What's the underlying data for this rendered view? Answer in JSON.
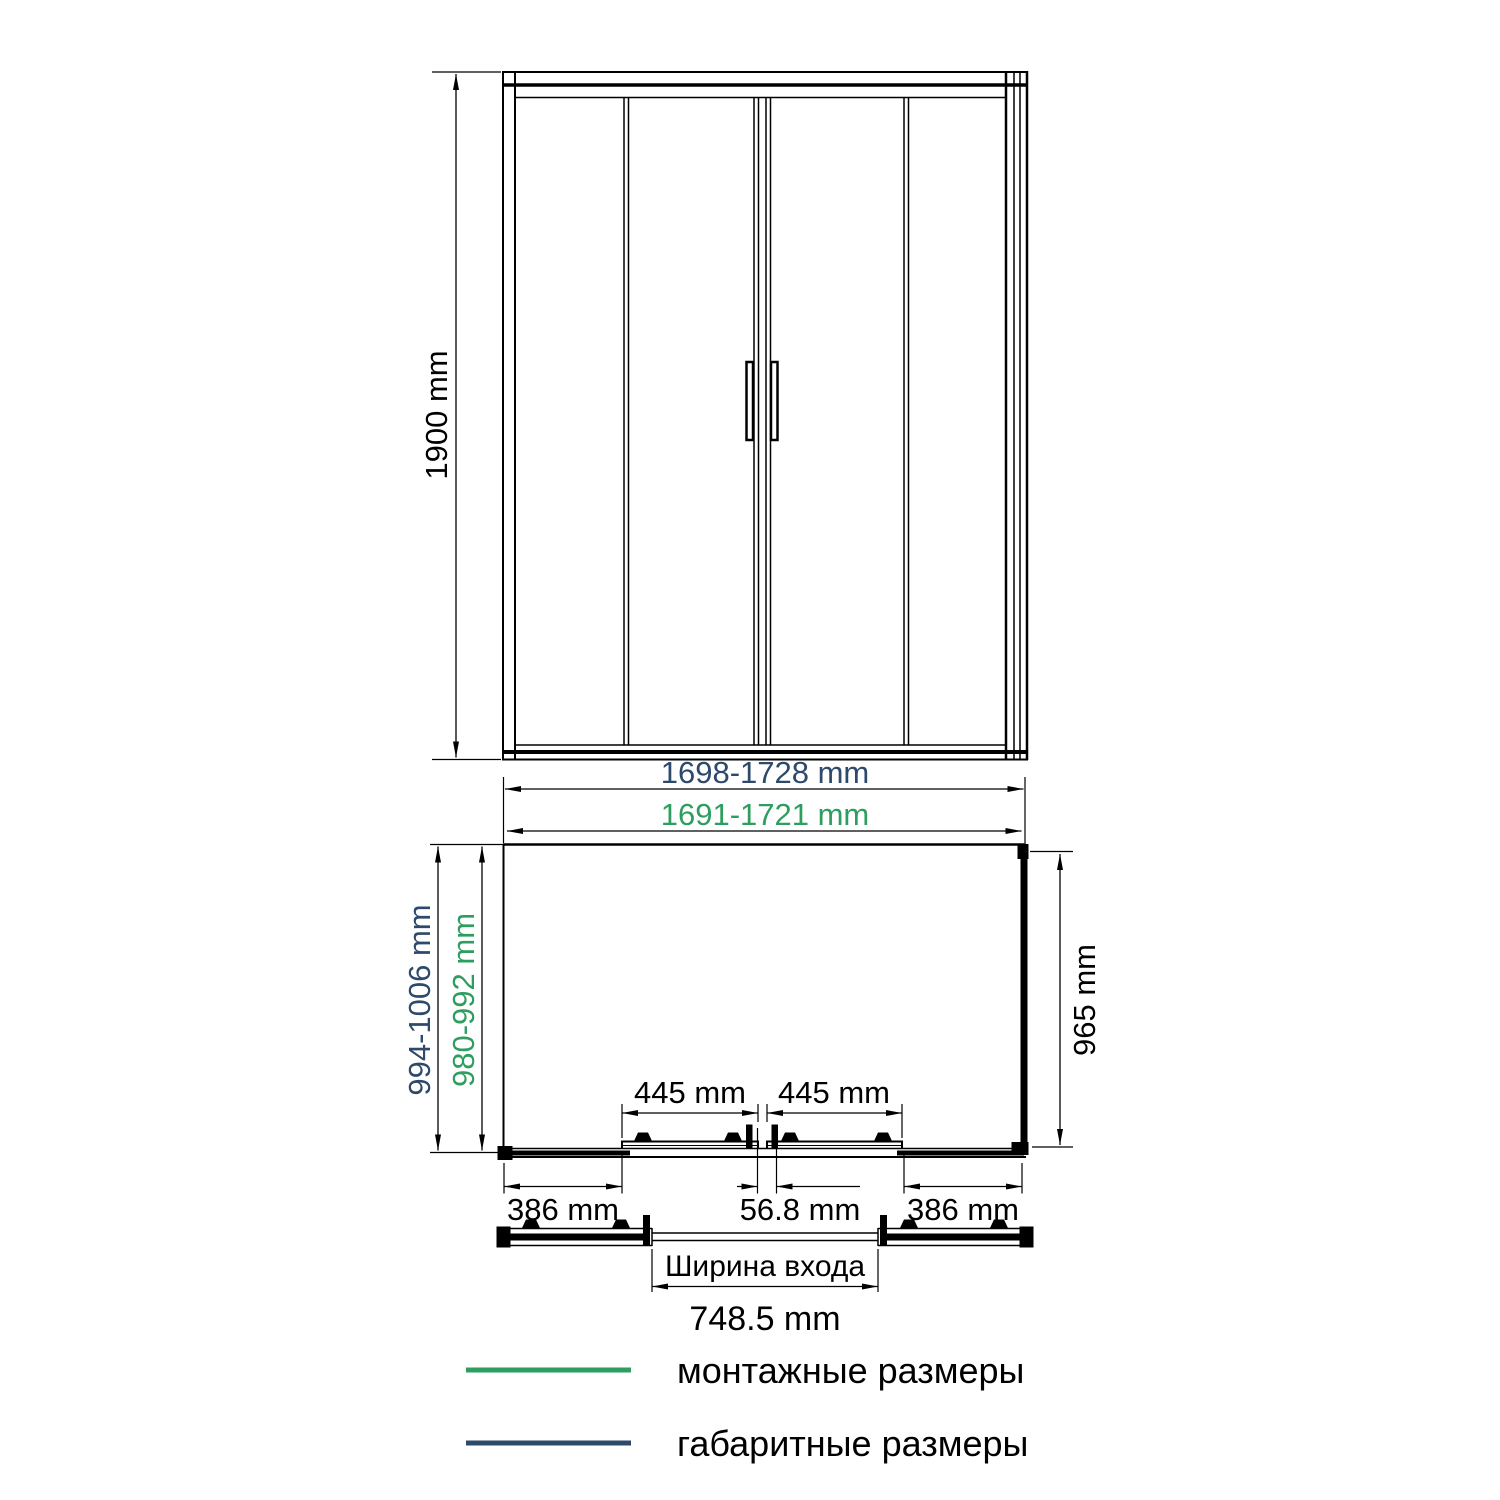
{
  "colors": {
    "overall_blue": "#2e4a6b",
    "mounting_green": "#2e9e60",
    "line_black": "#000000",
    "background": "#ffffff"
  },
  "front_view": {
    "height_label": "1900 mm"
  },
  "plan_view": {
    "overall_width_label": "1698-1728 mm",
    "mounting_width_label": "1691-1721 mm",
    "overall_depth_label": "994-1006 mm",
    "mounting_depth_label": "980-992 mm",
    "side_depth_label": "965 mm",
    "door_left_label": "445 mm",
    "door_right_label": "445 mm",
    "segment_left_label": "386 mm",
    "segment_center_label": "56.8 mm",
    "segment_right_label": "386 mm",
    "entrance_caption": "Ширина входа",
    "entrance_width_label": "748.5 mm"
  },
  "legend": {
    "mounting_label": "монтажные размеры",
    "overall_label": "габаритные размеры"
  }
}
